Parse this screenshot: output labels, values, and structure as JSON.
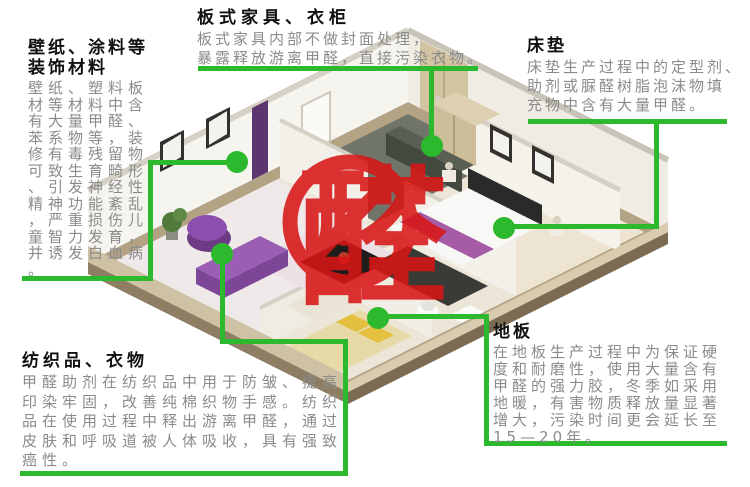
{
  "center": {
    "character": "醛",
    "meaning_note": "forbidden-formaldehyde-mark"
  },
  "colors": {
    "callout_green": "#2db92d",
    "alert_red": "#d81515",
    "title_text": "#111111",
    "body_text": "#8b8b8b"
  },
  "callouts": {
    "panel_furniture": {
      "title": "板式家具、衣柜",
      "body": "板式家具内部不做封面处理，\n暴露释放游离甲醛，直接污染衣物。"
    },
    "mattress": {
      "title": "床垫",
      "body": "床垫生产过程中的定型剂、\n助剂或脲醛树脂泡沫物填\n充物中含有大量甲醛。"
    },
    "wallpaper": {
      "title": "壁纸、涂料等\n装饰材料",
      "body": "壁纸、塑料板\n材等材料中含\n有大量甲醛、\n苯系物等，装\n修有毒残留物\n可致生育畸形\n、引发神经性\n精神功能紊乱\n，严重损伤儿\n童智力发育，\n并诱发白血病\n。"
    },
    "textile": {
      "title": "纺织品、衣物",
      "body": "甲醛助剂在纺织品中用于防皱、提高\n印染牢固，改善纯棉织物手感。纺织\n品在使用过程中释出游离甲醛，通过\n皮肤和呼吸道被人体吸收，具有强致\n癌性。"
    },
    "floor": {
      "title": "地板",
      "body": "在地板生产过程中为保证硬\n度和耐磨性，使用大量含有\n甲醛的强力胶，冬季如采用\n地暖，有害物质释放量显著\n增大，污染时间更会延长至\n15—20年。"
    }
  }
}
